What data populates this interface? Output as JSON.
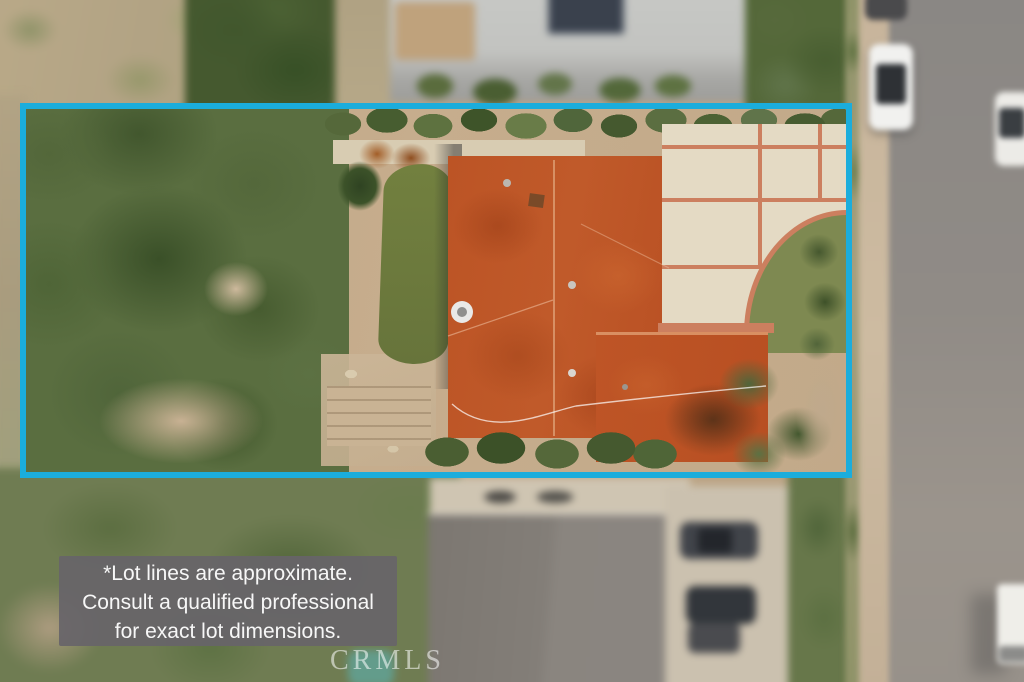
{
  "disclaimer": {
    "lines": {
      "0": "*Lot lines are approximate.",
      "1": "Consult a qualified professional",
      "2": "for exact lot dimensions."
    }
  },
  "watermark": {
    "text": "CRMLS"
  },
  "lot_outline": {
    "color": "#1BADDC"
  },
  "palette": {
    "roof_orange": "#BE5526",
    "lawn_green": "#6F7C42",
    "driveway_cream": "#E4DAC4",
    "driveway_divider_salmon": "#CC7F5F",
    "road_gray": "#908B86",
    "tree_green": "#4C6234",
    "dirt_tan": "#C1A98A",
    "disclaimer_background": "#676469"
  }
}
